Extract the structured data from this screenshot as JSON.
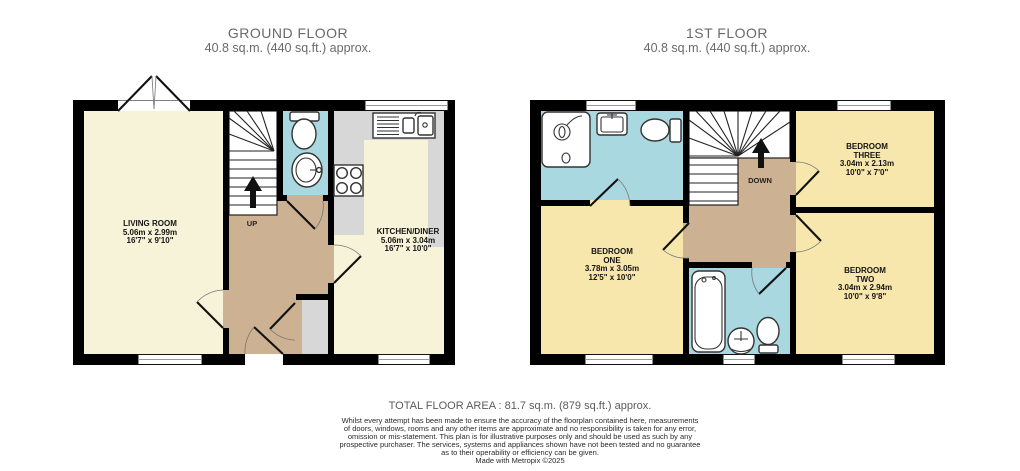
{
  "ground_floor": {
    "title": "GROUND FLOOR",
    "area_label": "40.8 sq.m. (440 sq.ft.) approx.",
    "stairs_label": "UP",
    "rooms": {
      "living_room": {
        "name": "LIVING ROOM",
        "size_metric": "5.06m x 2.99m",
        "size_imperial": "16'7\" x 9'10\""
      },
      "kitchen_diner": {
        "name": "KITCHEN/DINER",
        "size_metric": "5.06m x 3.04m",
        "size_imperial": "16'7\" x 10'0\""
      }
    }
  },
  "first_floor": {
    "title": "1ST FLOOR",
    "area_label": "40.8 sq.m. (440 sq.ft.) approx.",
    "stairs_label": "DOWN",
    "rooms": {
      "bedroom_one": {
        "name_line1": "BEDROOM",
        "name_line2": "ONE",
        "size_metric": "3.78m x 3.05m",
        "size_imperial": "12'5\" x 10'0\""
      },
      "bedroom_two": {
        "name_line1": "BEDROOM",
        "name_line2": "TWO",
        "size_metric": "3.04m x 2.94m",
        "size_imperial": "10'0\" x 9'8\""
      },
      "bedroom_three": {
        "name_line1": "BEDROOM",
        "name_line2": "THREE",
        "size_metric": "3.04m x 2.13m",
        "size_imperial": "10'0\" x 7'0\""
      }
    }
  },
  "footer": {
    "total_area": "TOTAL FLOOR AREA : 81.7 sq.m. (879 sq.ft.) approx.",
    "disclaimer_lines": [
      "Whilst every attempt has been made to ensure the accuracy of the floorplan contained here, measurements",
      "of doors, windows, rooms and any other items are approximate and no responsibility is taken for any error,",
      "omission or mis-statement. This plan is for illustrative purposes only and should be used as such by any",
      "prospective purchaser. The services, systems and appliances shown have not been tested and no guarantee",
      "as to their operability or efficiency can be given."
    ],
    "credit": "Made with Metropix ©2025"
  },
  "colors": {
    "wall": "#000000",
    "room_cream": "#f7f3d8",
    "room_yellow": "#f8e7ad",
    "hall_tan": "#ccb192",
    "wet_blue": "#a9d8e0",
    "counter_grey": "#d7d7d7",
    "header_text": "#6a6a6a",
    "label_text": "#141414"
  }
}
